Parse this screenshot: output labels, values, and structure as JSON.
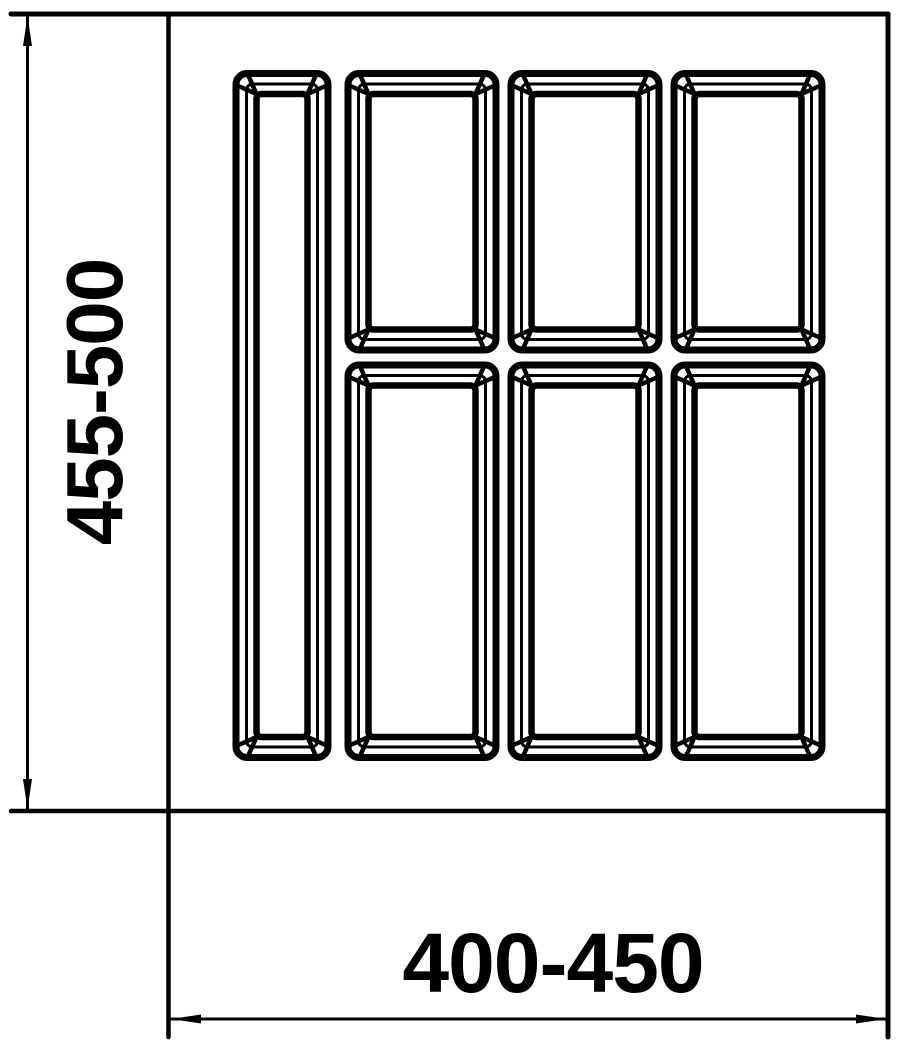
{
  "drawing": {
    "background_color": "#ffffff",
    "line_color": "#000000",
    "canvas": {
      "width": 904,
      "height": 1048
    },
    "vertical_dimension": {
      "label": "455-500",
      "line": {
        "x": 27.5,
        "y1": 16,
        "y2": 809
      },
      "label_center": {
        "x": 95,
        "y": 402
      },
      "font_size": 80
    },
    "horizontal_dimension": {
      "label": "400-450",
      "line": {
        "y": 1019,
        "x1": 171,
        "x2": 886
      },
      "label_center": {
        "x": 553,
        "y": 963
      },
      "font_size": 84
    },
    "tray_outline": {
      "top_line": {
        "x1": 11,
        "y1": 14,
        "x2": 888,
        "y2": 14,
        "stroke": 5
      },
      "bottom_line": {
        "x1": 11,
        "y1": 811,
        "x2": 888,
        "y2": 811,
        "stroke": 4.5
      },
      "left_line": {
        "x1": 168.5,
        "y1": 14,
        "x2": 168.5,
        "y2": 1037,
        "stroke": 4.5
      },
      "right_line": {
        "x1": 888,
        "y1": 14,
        "x2": 888,
        "y2": 1037,
        "stroke": 5
      }
    },
    "arrows": {
      "length": 30,
      "half_width": 4.5,
      "heads": [
        {
          "name": "vertical-dimension-arrow-up",
          "tip_x": 27.5,
          "tip_y": 16,
          "dir": "up"
        },
        {
          "name": "vertical-dimension-arrow-down",
          "tip_x": 27.5,
          "tip_y": 809,
          "dir": "down"
        },
        {
          "name": "horizontal-dimension-arrow-left",
          "tip_x": 171,
          "tip_y": 1019,
          "dir": "left"
        },
        {
          "name": "horizontal-dimension-arrow-right",
          "tip_x": 886,
          "tip_y": 1019,
          "dir": "right"
        }
      ]
    },
    "compartment_count": 7,
    "compartments": [
      {
        "x1": 236,
        "y1": 73.5,
        "x2": 328,
        "y2": 757.5
      },
      {
        "x1": 348,
        "y1": 73.5,
        "x2": 496,
        "y2": 350
      },
      {
        "x1": 511,
        "y1": 73.5,
        "x2": 659,
        "y2": 350
      },
      {
        "x1": 674,
        "y1": 73.5,
        "x2": 822,
        "y2": 350
      },
      {
        "x1": 348,
        "y1": 365,
        "x2": 496,
        "y2": 757.5
      },
      {
        "x1": 511,
        "y1": 365,
        "x2": 659,
        "y2": 757.5
      },
      {
        "x1": 674,
        "y1": 365,
        "x2": 822,
        "y2": 757.5
      }
    ],
    "bevel": {
      "outer_stroke": 7,
      "outer_radius": 11,
      "mid_inset": 10.5,
      "mid_stroke": 3,
      "mid_radius": 6,
      "inner_inset": 20.5,
      "inner_stroke": 6.5,
      "inner_radius": 5,
      "diag_stroke": 4.5,
      "diag_offset": 11
    }
  }
}
